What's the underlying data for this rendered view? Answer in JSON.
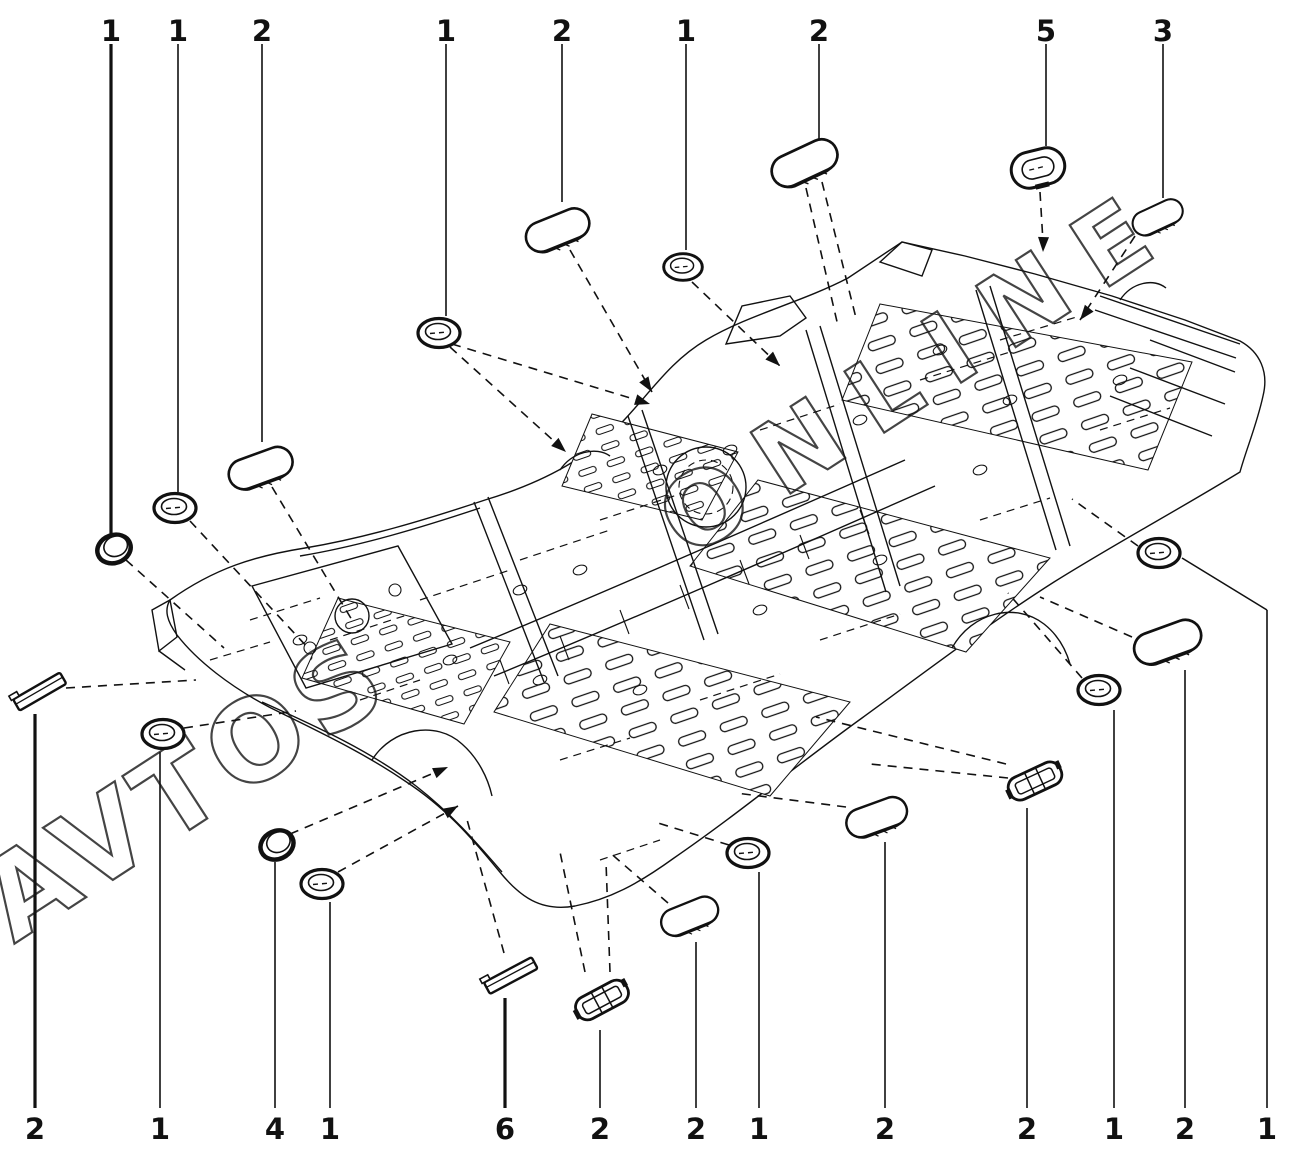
{
  "figure": {
    "width": 1306,
    "height": 1152,
    "background": "#ffffff",
    "line_color": "#111111",
    "description": "Car underbody floor-pan sealing plugs and grommets diagram"
  },
  "watermark": {
    "color": "#161616",
    "opacity": 0.8,
    "fragments": [
      {
        "text": "AVTOS",
        "x": 14,
        "y": 944,
        "rotation": -33,
        "font_size": 112,
        "letter_spacing": 8
      },
      {
        "text": "ONLINE",
        "x": 688,
        "y": 560,
        "rotation": -33,
        "font_size": 100,
        "letter_spacing": 28
      }
    ]
  },
  "callouts": [
    {
      "number": "1",
      "edge": "top",
      "x": 111,
      "y": 30,
      "line": [
        111,
        44,
        111,
        534
      ],
      "bold_line": true,
      "dashed": [
        [
          126,
          560,
          224,
          648
        ]
      ]
    },
    {
      "number": "1",
      "edge": "top",
      "x": 178,
      "y": 30,
      "line": [
        178,
        44,
        178,
        492
      ],
      "bold_line": false,
      "dashed": [
        [
          190,
          521,
          310,
          650
        ]
      ]
    },
    {
      "number": "2",
      "edge": "top",
      "x": 262,
      "y": 30,
      "line": [
        262,
        44,
        262,
        442
      ],
      "bold_line": false,
      "dashed": [
        [
          272,
          487,
          352,
          620
        ]
      ]
    },
    {
      "number": "1",
      "edge": "top",
      "x": 446,
      "y": 30,
      "line": [
        446,
        44,
        446,
        316
      ],
      "bold_line": false,
      "dashed": [
        [
          450,
          347,
          566,
          452
        ],
        [
          452,
          344,
          650,
          404
        ]
      ]
    },
    {
      "number": "2",
      "edge": "top",
      "x": 562,
      "y": 30,
      "line": [
        562,
        44,
        562,
        202
      ],
      "bold_line": false,
      "dashed": [
        [
          570,
          250,
          652,
          392
        ]
      ]
    },
    {
      "number": "1",
      "edge": "top",
      "x": 686,
      "y": 30,
      "line": [
        686,
        44,
        686,
        250
      ],
      "bold_line": false,
      "dashed": [
        [
          692,
          282,
          780,
          366
        ]
      ]
    },
    {
      "number": "2",
      "edge": "top",
      "x": 819,
      "y": 30,
      "line": [
        819,
        44,
        819,
        140
      ],
      "bold_line": false,
      "dashed": [
        [
          822,
          182,
          856,
          318
        ],
        [
          806,
          188,
          838,
          326
        ]
      ]
    },
    {
      "number": "5",
      "edge": "top",
      "x": 1046,
      "y": 30,
      "line": [
        1046,
        44,
        1046,
        146
      ],
      "bold_line": false,
      "dashed": [
        [
          1040,
          192,
          1043,
          242
        ]
      ]
    },
    {
      "number": "3",
      "edge": "top",
      "x": 1163,
      "y": 30,
      "line": [
        1163,
        44,
        1163,
        198
      ],
      "bold_line": false,
      "dashed": [
        [
          1135,
          236,
          1080,
          320
        ]
      ]
    },
    {
      "number": "2",
      "edge": "bottom",
      "x": 35,
      "y": 1128,
      "line": [
        35,
        1108,
        35,
        714
      ],
      "bold_line": true,
      "dashed": [
        [
          66,
          688,
          196,
          680
        ]
      ]
    },
    {
      "number": "1",
      "edge": "bottom",
      "x": 160,
      "y": 1128,
      "line": [
        160,
        1108,
        160,
        752
      ],
      "bold_line": false,
      "dashed": [
        [
          184,
          728,
          296,
          711
        ]
      ]
    },
    {
      "number": "4",
      "edge": "bottom",
      "x": 275,
      "y": 1128,
      "line": [
        275,
        1108,
        275,
        862
      ],
      "bold_line": false,
      "dashed": [
        [
          290,
          834,
          448,
          767
        ]
      ]
    },
    {
      "number": "1",
      "edge": "bottom",
      "x": 330,
      "y": 1128,
      "line": [
        330,
        1108,
        330,
        902
      ],
      "bold_line": false,
      "dashed": [
        [
          338,
          872,
          458,
          806
        ]
      ]
    },
    {
      "number": "6",
      "edge": "bottom",
      "x": 505,
      "y": 1128,
      "line": [
        505,
        1108,
        505,
        998
      ],
      "bold_line": true,
      "dashed": [
        [
          504,
          953,
          466,
          816
        ]
      ]
    },
    {
      "number": "2",
      "edge": "bottom",
      "x": 600,
      "y": 1128,
      "line": [
        600,
        1108,
        600,
        1030
      ],
      "bold_line": false,
      "dashed": [
        [
          585,
          972,
          560,
          852
        ],
        [
          610,
          972,
          606,
          862
        ]
      ]
    },
    {
      "number": "2",
      "edge": "bottom",
      "x": 696,
      "y": 1128,
      "line": [
        696,
        1108,
        696,
        942
      ],
      "bold_line": false,
      "dashed": [
        [
          668,
          903,
          608,
          851
        ]
      ]
    },
    {
      "number": "1",
      "edge": "bottom",
      "x": 759,
      "y": 1128,
      "line": [
        759,
        1108,
        759,
        872
      ],
      "bold_line": false,
      "dashed": [
        [
          729,
          845,
          658,
          823
        ]
      ]
    },
    {
      "number": "2",
      "edge": "bottom",
      "x": 885,
      "y": 1128,
      "line": [
        885,
        1108,
        885,
        842
      ],
      "bold_line": false,
      "dashed": [
        [
          846,
          807,
          736,
          793
        ]
      ]
    },
    {
      "number": "2",
      "edge": "bottom",
      "x": 1027,
      "y": 1128,
      "line": [
        1027,
        1108,
        1027,
        808
      ],
      "bold_line": false,
      "dashed": [
        [
          1006,
          764,
          816,
          717
        ],
        [
          1008,
          778,
          870,
          764
        ]
      ]
    },
    {
      "number": "1",
      "edge": "bottom",
      "x": 1114,
      "y": 1128,
      "line": [
        1114,
        1108,
        1114,
        710
      ],
      "bold_line": false,
      "dashed": [
        [
          1082,
          678,
          1008,
          593
        ]
      ]
    },
    {
      "number": "2",
      "edge": "bottom",
      "x": 1185,
      "y": 1128,
      "line": [
        1185,
        1108,
        1185,
        670
      ],
      "bold_line": false,
      "dashed": [
        [
          1132,
          637,
          1040,
          597
        ]
      ]
    },
    {
      "number": "1",
      "edge": "bottom",
      "x": 1267,
      "y": 1128,
      "line": [
        1267,
        1108,
        1267,
        610
      ],
      "extra": [
        1267,
        610,
        1182,
        558
      ],
      "bold_line": false,
      "dashed": [
        [
          1138,
          546,
          1072,
          499
        ]
      ]
    }
  ],
  "plugs": [
    {
      "type": "disc",
      "x": 114,
      "y": 549,
      "rot": -20,
      "scale": 1
    },
    {
      "type": "ring",
      "x": 175,
      "y": 508,
      "rot": 0,
      "scale": 1
    },
    {
      "type": "oval",
      "x": 261,
      "y": 469,
      "rot": -20,
      "scale": 1
    },
    {
      "type": "ring",
      "x": 439,
      "y": 333,
      "rot": 0,
      "scale": 1
    },
    {
      "type": "oval",
      "x": 558,
      "y": 231,
      "rot": -22,
      "scale": 1
    },
    {
      "type": "ring",
      "x": 683,
      "y": 267,
      "rot": 0,
      "scale": 0.92
    },
    {
      "type": "oval",
      "x": 805,
      "y": 164,
      "rot": -25,
      "scale": 1.05
    },
    {
      "type": "oval-ring",
      "x": 1038,
      "y": 168,
      "rot": -14,
      "scale": 1
    },
    {
      "type": "oval",
      "x": 1158,
      "y": 218,
      "rot": -25,
      "scale": 0.8
    },
    {
      "type": "strip",
      "x": 40,
      "y": 692,
      "rot": -30,
      "scale": 1
    },
    {
      "type": "ring",
      "x": 163,
      "y": 734,
      "rot": 0,
      "scale": 1
    },
    {
      "type": "disc",
      "x": 277,
      "y": 845,
      "rot": -25,
      "scale": 1
    },
    {
      "type": "ring",
      "x": 322,
      "y": 884,
      "rot": 0,
      "scale": 1
    },
    {
      "type": "strip",
      "x": 511,
      "y": 976,
      "rot": -28,
      "scale": 1
    },
    {
      "type": "capsule",
      "x": 602,
      "y": 1000,
      "rot": -28,
      "scale": 1
    },
    {
      "type": "oval",
      "x": 690,
      "y": 917,
      "rot": -22,
      "scale": 0.9
    },
    {
      "type": "ring",
      "x": 748,
      "y": 853,
      "rot": 0,
      "scale": 1
    },
    {
      "type": "oval",
      "x": 877,
      "y": 818,
      "rot": -20,
      "scale": 0.95
    },
    {
      "type": "capsule",
      "x": 1035,
      "y": 781,
      "rot": -25,
      "scale": 1
    },
    {
      "type": "ring",
      "x": 1099,
      "y": 690,
      "rot": 0,
      "scale": 1
    },
    {
      "type": "oval",
      "x": 1168,
      "y": 643,
      "rot": -20,
      "scale": 1.05
    },
    {
      "type": "ring",
      "x": 1159,
      "y": 553,
      "rot": 0,
      "scale": 1
    }
  ],
  "arrows": [
    {
      "x": 650,
      "y": 404,
      "angle": 17
    },
    {
      "x": 566,
      "y": 452,
      "angle": 42
    },
    {
      "x": 652,
      "y": 392,
      "angle": 57
    },
    {
      "x": 780,
      "y": 366,
      "angle": 44
    },
    {
      "x": 1043,
      "y": 252,
      "angle": 92
    },
    {
      "x": 1080,
      "y": 320,
      "angle": 128
    },
    {
      "x": 448,
      "y": 767,
      "angle": -24
    },
    {
      "x": 458,
      "y": 806,
      "angle": -30
    }
  ]
}
